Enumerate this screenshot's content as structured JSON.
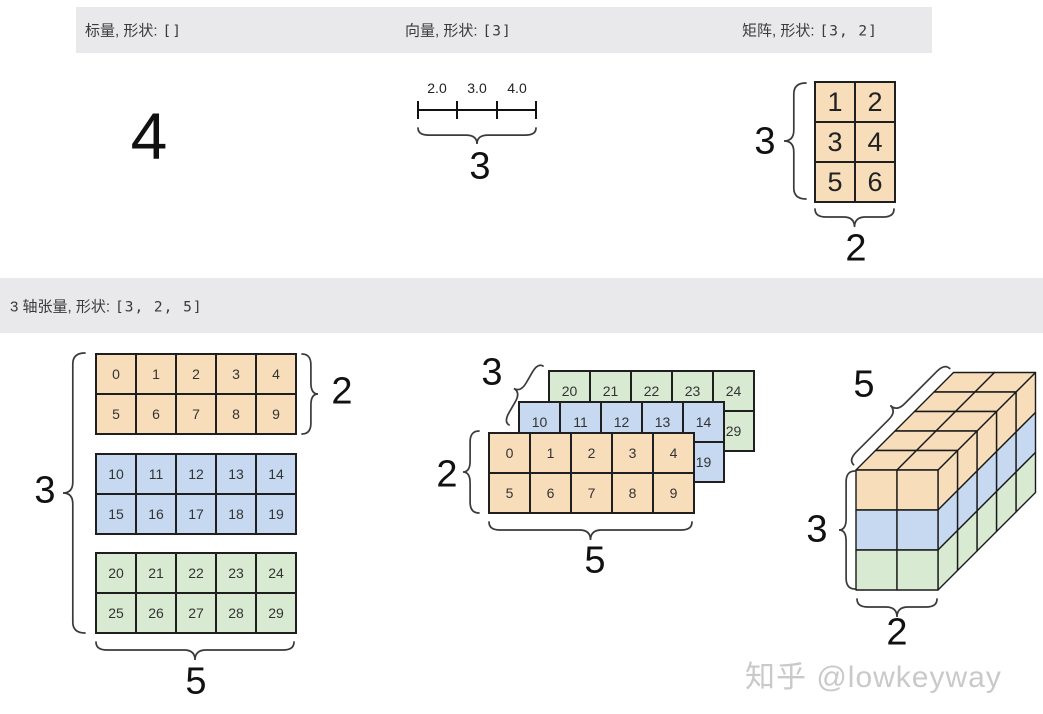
{
  "colors": {
    "peach": "#f8ddbb",
    "blue": "#c7d9f1",
    "green": "#d9ead3",
    "header_bg": "#e9e9eb",
    "brace": "#3a3a3a",
    "watermark": "#c9c9c9"
  },
  "headers": {
    "scalar_label": "标量, 形状:",
    "scalar_shape": "[]",
    "vector_label": "向量, 形状:",
    "vector_shape": "[3]",
    "matrix_label": "矩阵, 形状:",
    "matrix_shape": "[3, 2]",
    "tensor_label": "3 轴张量, 形状:",
    "tensor_shape": "[3, 2, 5]"
  },
  "scalar": {
    "value": "4"
  },
  "vector": {
    "ticks": [
      "2.0",
      "3.0",
      "4.0"
    ],
    "dim": "3"
  },
  "matrix": {
    "cells": [
      [
        "1",
        "2"
      ],
      [
        "3",
        "4"
      ],
      [
        "5",
        "6"
      ]
    ],
    "dim_rows": "3",
    "dim_cols": "2"
  },
  "tensor": {
    "slices": [
      {
        "color": "peach",
        "rows": [
          [
            "0",
            "1",
            "2",
            "3",
            "4"
          ],
          [
            "5",
            "6",
            "7",
            "8",
            "9"
          ]
        ]
      },
      {
        "color": "blue",
        "rows": [
          [
            "10",
            "11",
            "12",
            "13",
            "14"
          ],
          [
            "15",
            "16",
            "17",
            "18",
            "19"
          ]
        ]
      },
      {
        "color": "green",
        "rows": [
          [
            "20",
            "21",
            "22",
            "23",
            "24"
          ],
          [
            "25",
            "26",
            "27",
            "28",
            "29"
          ]
        ]
      }
    ],
    "flat": {
      "dim_axis": "3",
      "dim_rows": "2",
      "dim_cols": "5"
    },
    "stacked": {
      "dim_axis": "3",
      "dim_rows": "2",
      "dim_cols": "5"
    },
    "cube": {
      "dim_depth": "5",
      "dim_rows": "3",
      "dim_cols": "2"
    }
  },
  "watermark": "知乎 @lowkeyway"
}
